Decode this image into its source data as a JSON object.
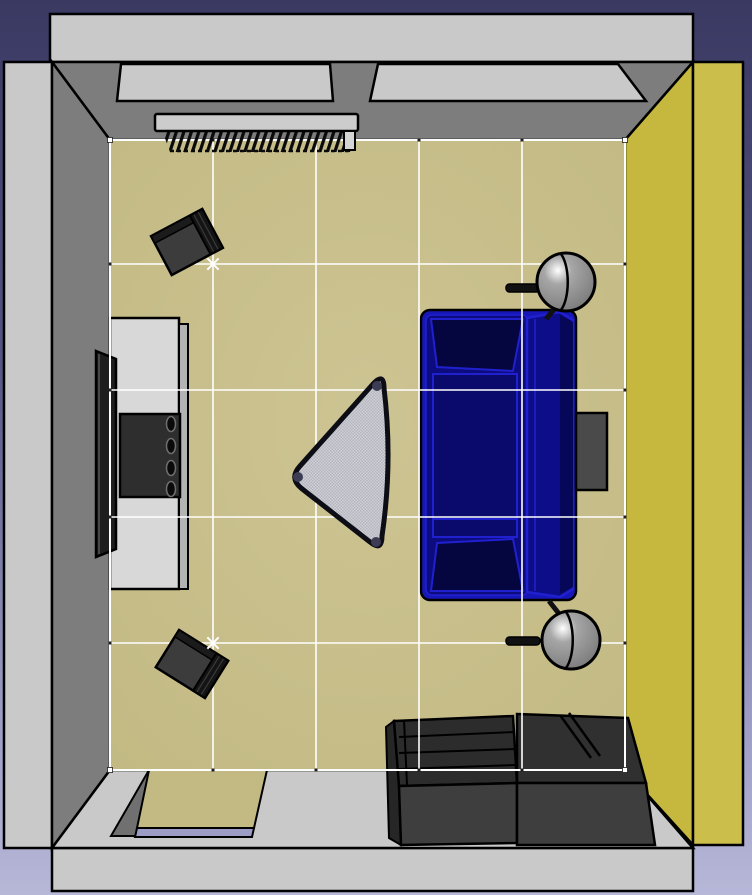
{
  "meta": {
    "app": "interior-design-3d-view",
    "view": "top-down aerial 3D rendering of a living room"
  },
  "palette": {
    "background_top": "#393962",
    "background_mid": "#545482",
    "background_low": "#9c9cc4",
    "background_bottom": "#b7b7d8",
    "outline": "#000000",
    "wall_outer": "#c9c9c9",
    "wall_shadow": "#7d7d7d",
    "wall_yellow": "#c6b83f",
    "wall_yellow_outer": "#ccbe4b",
    "floor_center": "#cdc493",
    "floor_edge": "#c2b983",
    "grid_line": "#ffffff",
    "marker_dark": "#1e1e1e",
    "marker_white": "#ffffff",
    "door_sill": "#9c9cc4",
    "door_jamb": "#707070",
    "radiator_bar": "#cccccc",
    "radiator_cap": "#d5d5d5",
    "radiator_fin": "#0a0a0a",
    "sofa_shell": "#1717b8",
    "sofa_body": "#0c0c7e",
    "sofa_dark": "#05053f",
    "sofa_seat": "#0a0a6c",
    "sofa_back": "#0d0d8a",
    "sofa_back_dark": "#07075a",
    "sofa_trim": "#2020cf",
    "lamp_mid": "#a6a6a6",
    "lamp_dark": "#737373",
    "lamp_hi": "#ffffff",
    "lamp_hardware": "#111111",
    "speaker_front": "#3c3c3c",
    "speaker_top": "#1b1b1b",
    "speaker_grill": "#141414",
    "speaker_grill_line": "#3a3a3a",
    "lowboard": "#d8d8d8",
    "lowboard_side": "#b3b3b3",
    "equipment": "#2e2e2e",
    "knob": "#0a0a0a",
    "knob_rim": "#6e6e6e",
    "tv": "#1e1e1e",
    "tv_edge": "#555555",
    "table_glass_a": "#cfcfd6",
    "table_glass_b": "#b5b5bf",
    "table_border": "#0d0d16",
    "table_dot": "#3c3c55",
    "cabinet_interior": "#2c2c2c",
    "cabinet_lid": "#303030",
    "cabinet_front": "#3e3e3e",
    "cabinet_side": "#262626",
    "side_table": "#4a4a4a"
  },
  "room": {
    "floor": "tan floor with white layout grid (5 x 5 cells)",
    "wall_top": "gray wall with two window recesses",
    "wall_left": "gray wall",
    "wall_right": "yellow wall",
    "wall_bottom": "gray wall with door opening"
  },
  "grid": {
    "columns": 5,
    "rows": 5,
    "line_color": "#ffffff"
  },
  "objects": [
    {
      "id": "radiator",
      "label": "wall radiator under left window"
    },
    {
      "id": "window-left",
      "label": "window recess (top left)"
    },
    {
      "id": "window-right",
      "label": "window recess (top right)"
    },
    {
      "id": "speaker-front",
      "label": "loudspeaker, angled (upper left)"
    },
    {
      "id": "speaker-rear",
      "label": "loudspeaker, angled (lower left)"
    },
    {
      "id": "tv",
      "label": "flat-screen TV"
    },
    {
      "id": "lowboard",
      "label": "TV lowboard"
    },
    {
      "id": "hifi-unit",
      "label": "hi-fi unit with four knobs"
    },
    {
      "id": "coffee-table",
      "label": "triangular glass coffee table"
    },
    {
      "id": "sofa",
      "label": "blue sofa"
    },
    {
      "id": "lamp-upper",
      "label": "sphere lamp (upper)"
    },
    {
      "id": "lamp-lower",
      "label": "sphere lamp (lower)"
    },
    {
      "id": "side-table",
      "label": "dark side table behind sofa"
    },
    {
      "id": "shelf-left",
      "label": "low open shelf unit"
    },
    {
      "id": "shelf-right",
      "label": "low shelf unit with lid"
    },
    {
      "id": "door",
      "label": "door opening in bottom wall"
    }
  ]
}
